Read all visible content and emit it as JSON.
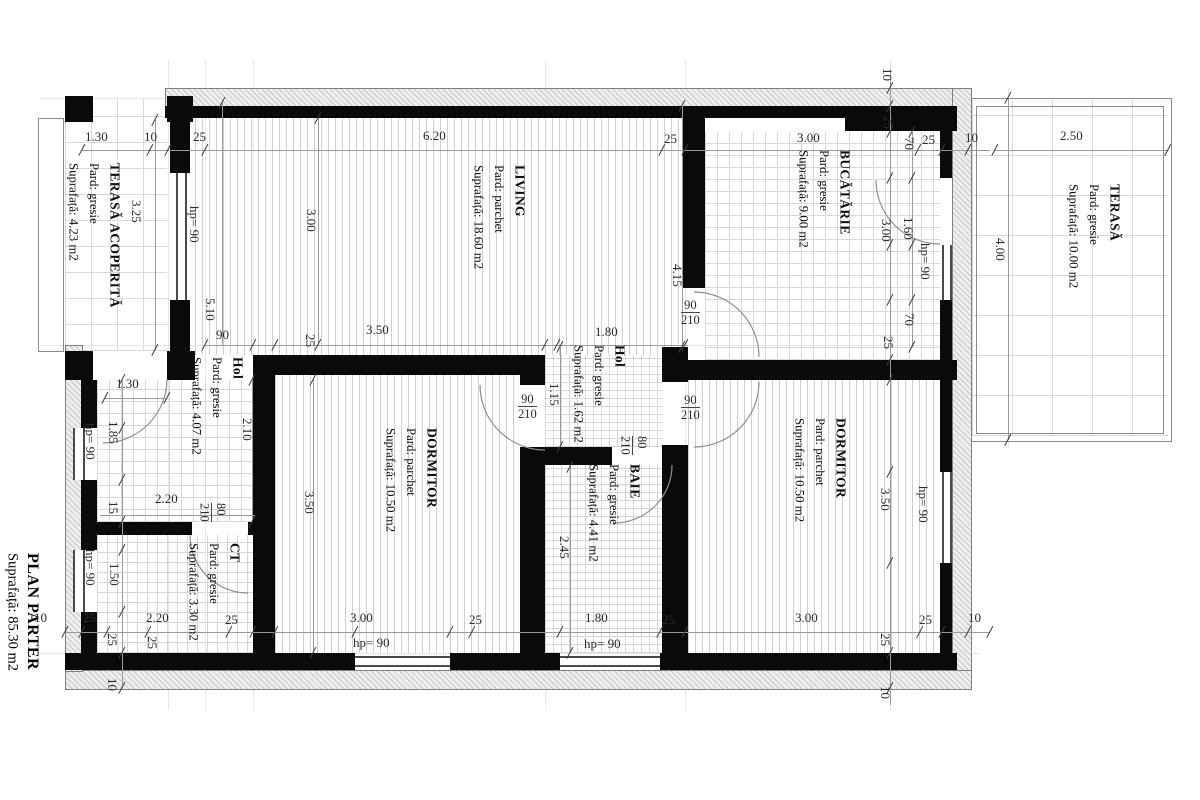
{
  "plan": {
    "title": "PLAN PARTER",
    "area": "Suprafață: 85.30 m2"
  },
  "rooms": [
    {
      "id": "terasa-acoperita",
      "name": "TERASĂ ACOPERITĂ",
      "floor": "Pard: gresie",
      "area": "Suprafață: 4.23 m2"
    },
    {
      "id": "living",
      "name": "LIVING",
      "floor": "Pard: parchet",
      "area": "Suprafață: 18.60 m2"
    },
    {
      "id": "bucatarie",
      "name": "BUCĂTĂRIE",
      "floor": "Pard: gresie",
      "area": "Suprafață: 9.00 m2"
    },
    {
      "id": "terasa",
      "name": "TERASĂ",
      "floor": "Pard: gresie",
      "area": "Suprafață: 10.00 m2"
    },
    {
      "id": "hol",
      "name": "Hol",
      "floor": "Pard: gresie",
      "area": "Suprafață: 4.07 m2"
    },
    {
      "id": "hol-mic",
      "name": "Hol",
      "floor": "Pard: gresie",
      "area": "Suprafață: 1.62 m2"
    },
    {
      "id": "dormitor-vest",
      "name": "DORMITOR",
      "floor": "Pard: parchet",
      "area": "Suprafață: 10.50 m2"
    },
    {
      "id": "dormitor-est",
      "name": "DORMITOR",
      "floor": "Pard: parchet",
      "area": "Suprafață: 10.50 m2"
    },
    {
      "id": "baie",
      "name": "BAIE",
      "floor": "Pard: gresie",
      "area": "Suprafață: 4.41 m2"
    },
    {
      "id": "ct",
      "name": "CT",
      "floor": "Pard: gresie",
      "area": "Suprafață: 3.30 m2"
    }
  ],
  "dim_labels": [
    {
      "t": "1.30",
      "x": 85,
      "y": 130,
      "v": false
    },
    {
      "t": "10",
      "x": 144,
      "y": 130,
      "v": false
    },
    {
      "t": "25",
      "x": 193,
      "y": 130,
      "v": false
    },
    {
      "t": "6.20",
      "x": 423,
      "y": 129,
      "v": false
    },
    {
      "t": "25",
      "x": 664,
      "y": 132,
      "v": false
    },
    {
      "t": "3.00",
      "x": 797,
      "y": 131,
      "v": false
    },
    {
      "t": "25",
      "x": 922,
      "y": 133,
      "v": false
    },
    {
      "t": "10",
      "x": 965,
      "y": 131,
      "v": false
    },
    {
      "t": "2.50",
      "x": 1060,
      "y": 129,
      "v": false
    },
    {
      "t": "90",
      "x": 216,
      "y": 328,
      "v": false
    },
    {
      "t": "3.50",
      "x": 366,
      "y": 323,
      "v": false
    },
    {
      "t": "1.80",
      "x": 595,
      "y": 325,
      "v": false
    },
    {
      "t": "1.30",
      "x": 116,
      "y": 377,
      "v": false
    },
    {
      "t": "2.20",
      "x": 155,
      "y": 492,
      "v": false
    },
    {
      "t": "10",
      "x": 34,
      "y": 611,
      "v": false
    },
    {
      "t": "25",
      "x": 83,
      "y": 611,
      "v": false
    },
    {
      "t": "2.20",
      "x": 146,
      "y": 611,
      "v": false
    },
    {
      "t": "25",
      "x": 225,
      "y": 613,
      "v": false
    },
    {
      "t": "3.00",
      "x": 350,
      "y": 611,
      "v": false
    },
    {
      "t": "25",
      "x": 469,
      "y": 613,
      "v": false
    },
    {
      "t": "1.80",
      "x": 585,
      "y": 611,
      "v": false
    },
    {
      "t": "25",
      "x": 662,
      "y": 613,
      "v": false
    },
    {
      "t": "3.00",
      "x": 795,
      "y": 611,
      "v": false
    },
    {
      "t": "25",
      "x": 919,
      "y": 613,
      "v": false
    },
    {
      "t": "10",
      "x": 968,
      "y": 611,
      "v": false
    },
    {
      "t": "hp= 90",
      "x": 353,
      "y": 636,
      "v": false
    },
    {
      "t": "hp= 90",
      "x": 584,
      "y": 637,
      "v": false
    },
    {
      "t": "3.25",
      "x": 130,
      "y": 200,
      "v": true
    },
    {
      "t": "hp= 90",
      "x": 188,
      "y": 206,
      "v": true
    },
    {
      "t": "3.00",
      "x": 305,
      "y": 209,
      "v": true
    },
    {
      "t": "5.10",
      "x": 204,
      "y": 298,
      "v": true
    },
    {
      "t": "25",
      "x": 304,
      "y": 334,
      "v": true
    },
    {
      "t": "1.85",
      "x": 107,
      "y": 421,
      "v": true
    },
    {
      "t": "hp= 90",
      "x": 84,
      "y": 423,
      "v": true
    },
    {
      "t": "15",
      "x": 107,
      "y": 501,
      "v": true
    },
    {
      "t": "1.50",
      "x": 108,
      "y": 563,
      "v": true
    },
    {
      "t": "hp= 90",
      "x": 84,
      "y": 549,
      "v": true
    },
    {
      "t": "25",
      "x": 106,
      "y": 633,
      "v": true
    },
    {
      "t": "25",
      "x": 146,
      "y": 636,
      "v": true
    },
    {
      "t": "10",
      "x": 106,
      "y": 678,
      "v": true
    },
    {
      "t": "2.10",
      "x": 241,
      "y": 418,
      "v": true
    },
    {
      "t": "3.50",
      "x": 303,
      "y": 491,
      "v": true
    },
    {
      "t": "1.15",
      "x": 548,
      "y": 383,
      "v": true
    },
    {
      "t": "2.45",
      "x": 558,
      "y": 536,
      "v": true
    },
    {
      "t": "4.15",
      "x": 671,
      "y": 264,
      "v": true
    },
    {
      "t": "10",
      "x": 881,
      "y": 68,
      "v": true
    },
    {
      "t": "25",
      "x": 882,
      "y": 116,
      "v": true
    },
    {
      "t": "70",
      "x": 903,
      "y": 137,
      "v": true
    },
    {
      "t": "3.00",
      "x": 880,
      "y": 219,
      "v": true
    },
    {
      "t": "1.60",
      "x": 902,
      "y": 217,
      "v": true
    },
    {
      "t": "hp= 90",
      "x": 919,
      "y": 243,
      "v": true
    },
    {
      "t": "70",
      "x": 903,
      "y": 313,
      "v": true
    },
    {
      "t": "25",
      "x": 882,
      "y": 336,
      "v": true
    },
    {
      "t": "3.50",
      "x": 879,
      "y": 488,
      "v": true
    },
    {
      "t": "hp= 90",
      "x": 917,
      "y": 486,
      "v": true
    },
    {
      "t": "25",
      "x": 879,
      "y": 633,
      "v": true
    },
    {
      "t": "10",
      "x": 879,
      "y": 686,
      "v": true
    },
    {
      "t": "4.00",
      "x": 994,
      "y": 238,
      "v": true
    }
  ],
  "door_labels": [
    {
      "a": "90",
      "b": "210",
      "x": 681,
      "y": 298,
      "v": false
    },
    {
      "a": "90",
      "b": "210",
      "x": 518,
      "y": 392,
      "v": false
    },
    {
      "a": "90",
      "b": "210",
      "x": 681,
      "y": 393,
      "v": false
    },
    {
      "a": "80",
      "b": "210",
      "x": 618,
      "y": 436,
      "v": true
    },
    {
      "a": "80",
      "b": "210",
      "x": 197,
      "y": 503,
      "v": true
    }
  ],
  "ticks": [
    [
      82,
      150
    ],
    [
      150,
      150
    ],
    [
      168,
      150
    ],
    [
      205,
      150
    ],
    [
      662,
      150
    ],
    [
      685,
      150
    ],
    [
      918,
      150
    ],
    [
      942,
      150
    ],
    [
      968,
      150
    ],
    [
      995,
      150
    ],
    [
      1168,
      150
    ],
    [
      65,
      632
    ],
    [
      82,
      632
    ],
    [
      107,
      632
    ],
    [
      148,
      632
    ],
    [
      229,
      632
    ],
    [
      253,
      632
    ],
    [
      275,
      632
    ],
    [
      355,
      632
    ],
    [
      450,
      632
    ],
    [
      472,
      632
    ],
    [
      560,
      632
    ],
    [
      660,
      632
    ],
    [
      685,
      632
    ],
    [
      920,
      632
    ],
    [
      942,
      632
    ],
    [
      968,
      632
    ],
    [
      990,
      632
    ],
    [
      205,
      345
    ],
    [
      253,
      345
    ],
    [
      275,
      345
    ],
    [
      545,
      345
    ],
    [
      557,
      345
    ],
    [
      685,
      345
    ],
    [
      105,
      398
    ],
    [
      167,
      398
    ],
    [
      122,
      380
    ],
    [
      122,
      428
    ],
    [
      122,
      480
    ],
    [
      122,
      522
    ],
    [
      122,
      550
    ],
    [
      122,
      612
    ],
    [
      122,
      653
    ],
    [
      122,
      688
    ],
    [
      155,
      120
    ],
    [
      155,
      350
    ],
    [
      222,
      103
    ],
    [
      318,
      118
    ],
    [
      318,
      345
    ],
    [
      313,
      380
    ],
    [
      313,
      653
    ],
    [
      252,
      380
    ],
    [
      252,
      522
    ],
    [
      560,
      347
    ],
    [
      560,
      447
    ],
    [
      570,
      467
    ],
    [
      570,
      653
    ],
    [
      682,
      106
    ],
    [
      682,
      347
    ],
    [
      890,
      88
    ],
    [
      890,
      106
    ],
    [
      890,
      132
    ],
    [
      890,
      178
    ],
    [
      890,
      245
    ],
    [
      890,
      300
    ],
    [
      890,
      360
    ],
    [
      890,
      380
    ],
    [
      890,
      472
    ],
    [
      890,
      563
    ],
    [
      890,
      653
    ],
    [
      890,
      688
    ],
    [
      912,
      132
    ],
    [
      912,
      178
    ],
    [
      912,
      245
    ],
    [
      912,
      300
    ],
    [
      912,
      347
    ],
    [
      1008,
      98
    ],
    [
      1008,
      440
    ]
  ]
}
